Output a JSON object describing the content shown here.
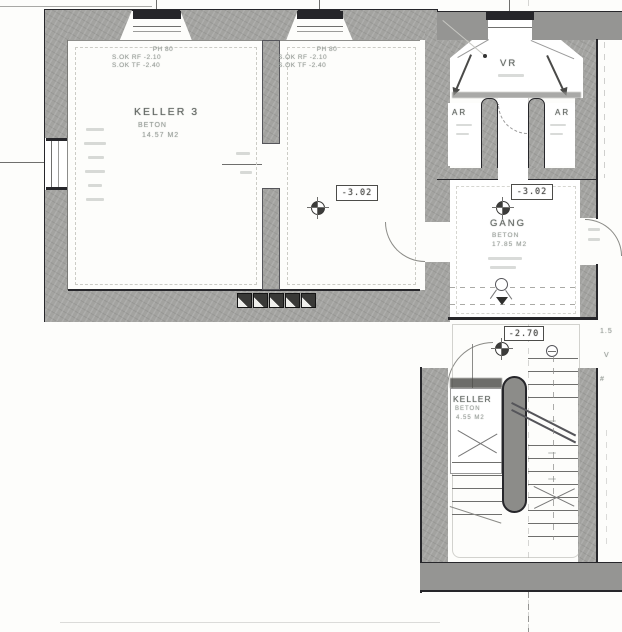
{
  "plan": {
    "title": "Kellergeschoss Grundriss (scanned basement floor plan)",
    "colors": {
      "wall_gray": "#a3a3a0",
      "outline_black": "#26262a",
      "paper": "#fdfdfb",
      "faint_text": "#9aa09b"
    },
    "rooms": {
      "keller3": {
        "name": "KELLER 3",
        "material": "BETON",
        "area": "14.57 M2"
      },
      "vr": {
        "name": "VR"
      },
      "ar_left": {
        "name": "AR"
      },
      "ar_right": {
        "name": "AR"
      },
      "gang": {
        "name": "GANG",
        "material": "BETON",
        "area": "17.85 M2"
      },
      "keller_stair": {
        "name": "KELLER",
        "material": "BETON",
        "area": "4.55 M2"
      }
    },
    "levels": {
      "room2": "-3.02",
      "gang": "-3.02",
      "landing": "-2.70"
    },
    "window_notes": {
      "win1": {
        "l1": "PH 80",
        "l2": "S.OK RF -2.10",
        "l3": "S.OK TF -2.40"
      },
      "win2": {
        "l1": "PH 80",
        "l2": "S.OK RF -2.10",
        "l3": "S.OK TF -2.40"
      }
    },
    "edge_fragments": {
      "f1": "1.5",
      "f2": "V",
      "f3": "#"
    }
  }
}
